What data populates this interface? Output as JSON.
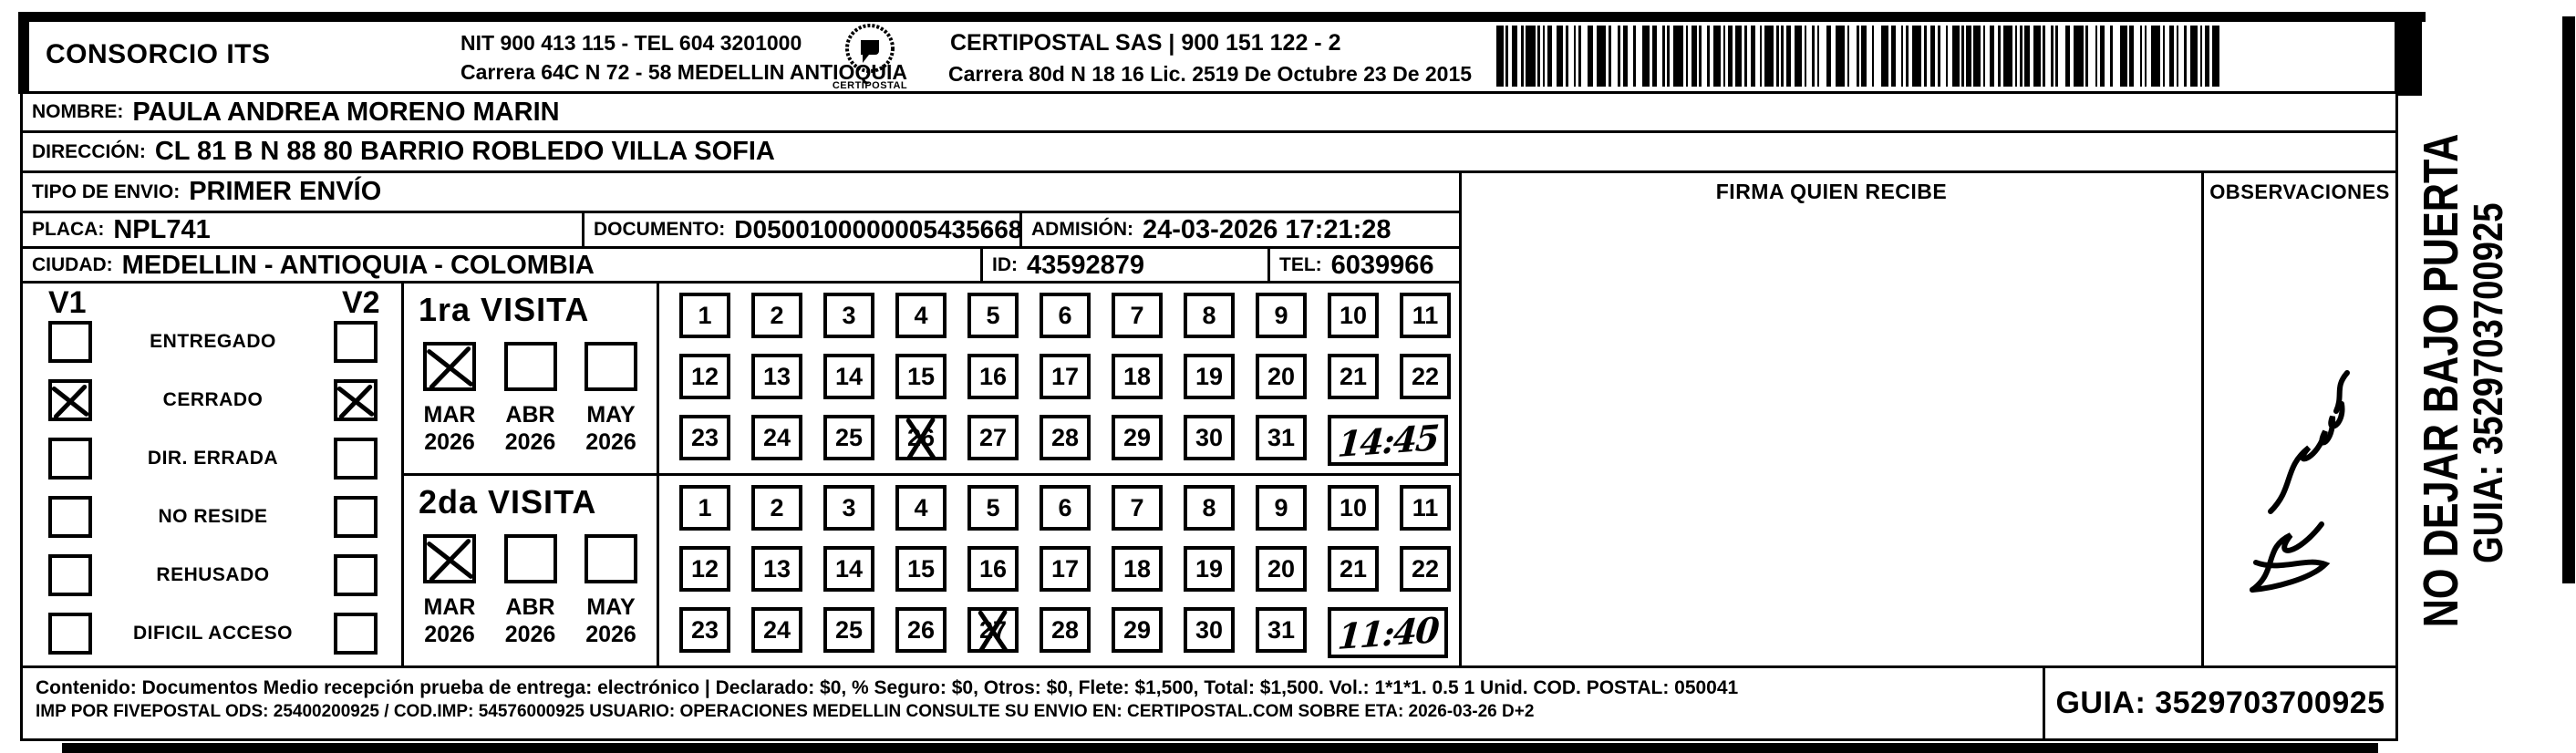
{
  "header": {
    "company": "CONSORCIO ITS",
    "nit_tel": "NIT 900 413 115 - TEL 604 3201000",
    "company_address": "Carrera 64C N 72 - 58 MEDELLIN ANTIOQUIA",
    "logo_name": "CERTIPOSTAL",
    "certipostal_line": "CERTIPOSTAL SAS | 900 151 122 - 2",
    "certipostal_address": "Carrera 80d N 18 16  Lic. 2519 De Octubre 23 De 2015"
  },
  "shipment": {
    "nombre_label": "NOMBRE:",
    "nombre": "PAULA ANDREA MORENO MARIN",
    "direccion_label": "DIRECCIÓN:",
    "direccion": "CL 81 B N 88 80 BARRIO ROBLEDO VILLA SOFIA",
    "tipo_envio_label": "TIPO DE ENVIO:",
    "tipo_envio": "PRIMER ENVÍO",
    "placa_label": "PLACA:",
    "placa": "NPL741",
    "documento_label": "DOCUMENTO:",
    "documento": "D05001000000054356683",
    "admision_label": "ADMISIÓN:",
    "admision": "24-03-2026 17:21:28",
    "ciudad_label": "CIUDAD:",
    "ciudad": "MEDELLIN - ANTIOQUIA - COLOMBIA",
    "id_label": "ID:",
    "id": "43592879",
    "tel_label": "TEL:",
    "tel": "6039966"
  },
  "columns": {
    "firma": "FIRMA QUIEN RECIBE",
    "observaciones": "OBSERVACIONES"
  },
  "status": {
    "v1": "V1",
    "v2": "V2",
    "items": [
      {
        "label": "ENTREGADO",
        "v1": false,
        "v2": false
      },
      {
        "label": "CERRADO",
        "v1": true,
        "v2": true
      },
      {
        "label": "DIR. ERRADA",
        "v1": false,
        "v2": false
      },
      {
        "label": "NO RESIDE",
        "v1": false,
        "v2": false
      },
      {
        "label": "REHUSADO",
        "v1": false,
        "v2": false
      },
      {
        "label": "DIFICIL ACCESO",
        "v1": false,
        "v2": false
      }
    ]
  },
  "visits": [
    {
      "title": "1ra VISITA",
      "months": [
        {
          "label": "MAR",
          "year": "2026",
          "checked": true
        },
        {
          "label": "ABR",
          "year": "2026",
          "checked": false
        },
        {
          "label": "MAY",
          "year": "2026",
          "checked": false
        }
      ],
      "days_in_month": 31,
      "crossed_day": 26,
      "handwritten_time": "14:45"
    },
    {
      "title": "2da VISITA",
      "months": [
        {
          "label": "MAR",
          "year": "2026",
          "checked": true
        },
        {
          "label": "ABR",
          "year": "2026",
          "checked": false
        },
        {
          "label": "MAY",
          "year": "2026",
          "checked": false
        }
      ],
      "days_in_month": 31,
      "crossed_day": 27,
      "handwritten_time": "11:40"
    }
  ],
  "footer": {
    "line1": "Contenido: Documentos Medio recepción prueba de entrega: electrónico | Declarado: $0, % Seguro: $0, Otros: $0, Flete: $1,500, Total: $1,500. Vol.: 1*1*1. 0.5  1 Unid. COD. POSTAL: 050041",
    "line2": "IMP POR FIVEPOSTAL ODS: 25400200925 / COD.IMP: 54576000925 USUARIO: OPERACIONES MEDELLIN CONSULTE SU ENVIO EN: CERTIPOSTAL.COM SOBRE ETA: 2026-03-26 D+2",
    "guia_box": "GUIA: 3529703700925"
  },
  "side": {
    "warning": "NO DEJAR BAJO PUERTA",
    "guia": "GUIA: 3529703700925"
  },
  "colors": {
    "ink": "#000000",
    "paper": "#ffffff"
  }
}
